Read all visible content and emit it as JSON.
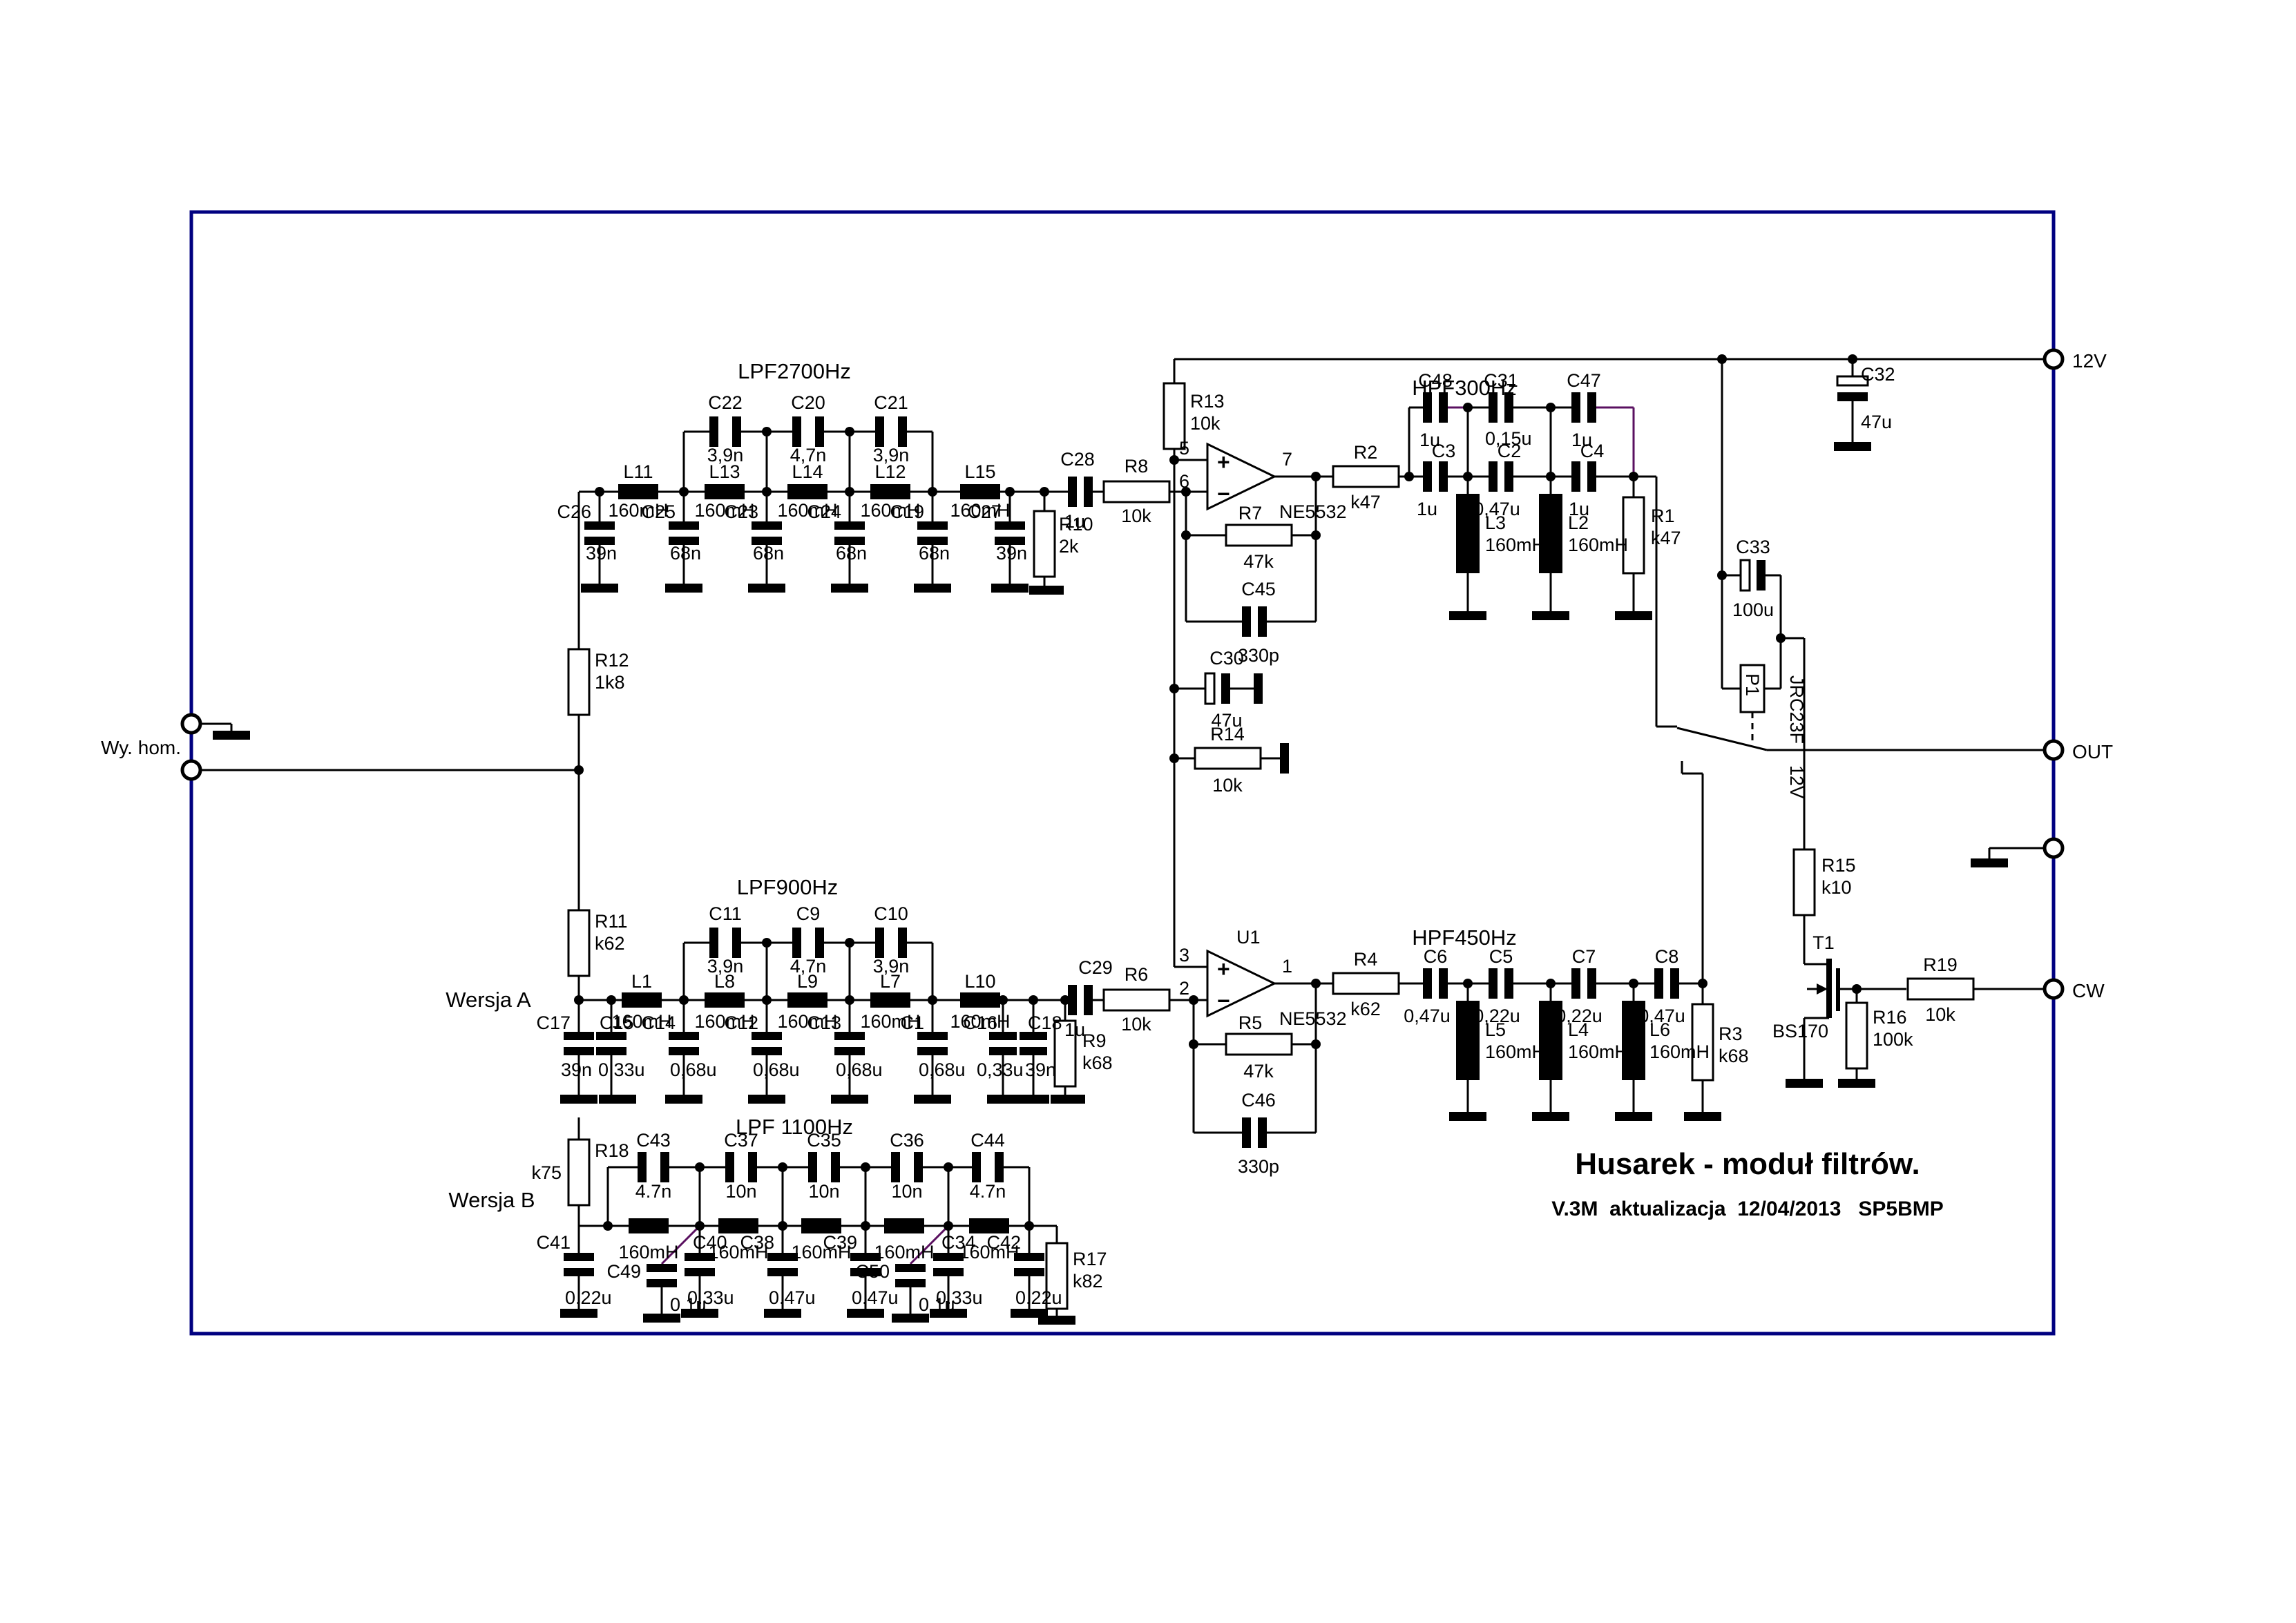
{
  "input": {
    "label": "Wy. hom."
  },
  "terminals": {
    "v12": "12V",
    "out": "OUT",
    "cw": "CW"
  },
  "versions": {
    "a": "Wersja A",
    "b": "Wersja B"
  },
  "title_block": {
    "title": "Husarek - moduł filtrów.",
    "subtitle": "V.3M  aktualizacja  12/04/2013   SP5BMP"
  },
  "lpf2700": {
    "title": "LPF2700Hz",
    "input_res": {
      "ref": "R12",
      "value": "1k8"
    },
    "bridges": [
      {
        "ref": "C22",
        "value": "3,9n"
      },
      {
        "ref": "C20",
        "value": "4,7n"
      },
      {
        "ref": "C21",
        "value": "3,9n"
      }
    ],
    "inductors": [
      {
        "ref": "L11",
        "value": "160mH"
      },
      {
        "ref": "L13",
        "value": "160mH"
      },
      {
        "ref": "L14",
        "value": "160mH"
      },
      {
        "ref": "L12",
        "value": "160mH"
      },
      {
        "ref": "L15",
        "value": "160mH"
      }
    ],
    "shunts": [
      {
        "ref": "C26",
        "value": "39n"
      },
      {
        "ref": "C25",
        "value": "68n"
      },
      {
        "ref": "C23",
        "value": "68n"
      },
      {
        "ref": "C24",
        "value": "68n"
      },
      {
        "ref": "C19",
        "value": "68n"
      },
      {
        "ref": "C27",
        "value": "39n"
      }
    ],
    "out_cap": {
      "ref": "C28",
      "value": "1u"
    },
    "shunt_res": {
      "ref": "R10",
      "value": "2k"
    },
    "series_res": {
      "ref": "R8",
      "value": "10k"
    }
  },
  "lpf900": {
    "title": "LPF900Hz",
    "input_res": {
      "ref": "R11",
      "value": "k62"
    },
    "bridges": [
      {
        "ref": "C11",
        "value": "3,9n"
      },
      {
        "ref": "C9",
        "value": "4,7n"
      },
      {
        "ref": "C10",
        "value": "3,9n"
      }
    ],
    "inductors": [
      {
        "ref": "L1",
        "value": "160mH"
      },
      {
        "ref": "L8",
        "value": "160mH"
      },
      {
        "ref": "L9",
        "value": "160mH"
      },
      {
        "ref": "L7",
        "value": "160mH"
      },
      {
        "ref": "L10",
        "value": "160mH"
      }
    ],
    "shunts": [
      {
        "ref": "C17",
        "value": "39n"
      },
      {
        "ref": "C15",
        "value": "0,33u"
      },
      {
        "ref": "C14",
        "value": "0,68u"
      },
      {
        "ref": "C12",
        "value": "0,68u"
      },
      {
        "ref": "C13",
        "value": "0,68u"
      },
      {
        "ref": "C1",
        "value": "0,68u"
      },
      {
        "ref": "C16",
        "value": "0,33u"
      },
      {
        "ref": "C18",
        "value": "39n"
      }
    ],
    "out_cap": {
      "ref": "C29",
      "value": "1u"
    },
    "shunt_res": {
      "ref": "R9",
      "value": "k68"
    },
    "series_res": {
      "ref": "R6",
      "value": "10k"
    }
  },
  "lpf1100": {
    "title": "LPF 1100Hz",
    "input_res": {
      "ref": "R18",
      "value": "k75"
    },
    "bridges": [
      {
        "ref": "C43",
        "value": "4.7n"
      },
      {
        "ref": "C37",
        "value": "10n"
      },
      {
        "ref": "C35",
        "value": "10n"
      },
      {
        "ref": "C36",
        "value": "10n"
      },
      {
        "ref": "C44",
        "value": "4.7n"
      }
    ],
    "inductor_value": "160mH",
    "shunts": [
      {
        "ref": "C41",
        "value": "0.22u"
      },
      {
        "ref": "C40",
        "value": "0.33u"
      },
      {
        "ref": "C38",
        "value": "0.47u"
      },
      {
        "ref": "C39",
        "value": "0.47u"
      },
      {
        "ref": "C34",
        "value": "0.33u"
      },
      {
        "ref": "C42",
        "value": "0.22u"
      }
    ],
    "mods": [
      {
        "ref": "C49",
        "value": "0.1u"
      },
      {
        "ref": "C50",
        "value": "0.1u"
      }
    ],
    "shunt_res": {
      "ref": "R17",
      "value": "k82"
    }
  },
  "hpf300": {
    "title": "HPF300Hz",
    "top_caps": [
      {
        "ref": "C48",
        "value": "1u"
      },
      {
        "ref": "C31",
        "value": "0,15u"
      },
      {
        "ref": "C47",
        "value": "1u"
      }
    ],
    "series_caps": [
      {
        "ref": "C3",
        "value": "1u"
      },
      {
        "ref": "C2",
        "value": "0,47u"
      },
      {
        "ref": "C4",
        "value": "1u"
      }
    ],
    "inductors": [
      {
        "ref": "L3",
        "value": "160mH"
      },
      {
        "ref": "L2",
        "value": "160mH"
      }
    ],
    "shunt_res": {
      "ref": "R1",
      "value": "k47"
    },
    "series_res": {
      "ref": "R2",
      "value": "k47"
    }
  },
  "hpf450": {
    "title": "HPF450Hz",
    "series_caps": [
      {
        "ref": "C6",
        "value": "0,47u"
      },
      {
        "ref": "C5",
        "value": "0,22u"
      },
      {
        "ref": "C7",
        "value": "0,22u"
      },
      {
        "ref": "C8",
        "value": "0,47u"
      }
    ],
    "inductors": [
      {
        "ref": "L5",
        "value": "160mH"
      },
      {
        "ref": "L4",
        "value": "160mH"
      },
      {
        "ref": "L6",
        "value": "160mH"
      }
    ],
    "shunt_res": {
      "ref": "R3",
      "value": "k68"
    },
    "series_res": {
      "ref": "R4",
      "value": "k62"
    }
  },
  "opamp1": {
    "part": "NE5532",
    "pin_plus": "5",
    "pin_minus": "6",
    "pin_out": "7",
    "plus": "+",
    "minus": "−",
    "fb_res": {
      "ref": "R7",
      "value": "47k"
    },
    "fb_cap": {
      "ref": "C45",
      "value": "330p"
    }
  },
  "opamp2": {
    "ref": "U1",
    "part": "NE5532",
    "pin_plus": "3",
    "pin_minus": "2",
    "pin_out": "1",
    "plus": "+",
    "minus": "−",
    "fb_res": {
      "ref": "R5",
      "value": "47k"
    },
    "fb_cap": {
      "ref": "C46",
      "value": "330p"
    }
  },
  "bias": {
    "top_res": {
      "ref": "R13",
      "value": "10k"
    },
    "bottom_res": {
      "ref": "R14",
      "value": "10k"
    },
    "cap": {
      "ref": "C30",
      "value": "47u"
    }
  },
  "power_cap": {
    "ref": "C32",
    "value": "47u"
  },
  "relay": {
    "ref": "P1",
    "part": "JRC23F",
    "voltage": "12V",
    "cap": {
      "ref": "C33",
      "value": "100u"
    },
    "series_res": {
      "ref": "R15",
      "value": "k10"
    }
  },
  "driver": {
    "ref": "T1",
    "part": "BS170",
    "gate_res": {
      "ref": "R16",
      "value": "100k"
    },
    "cw_res": {
      "ref": "R19",
      "value": "10k"
    }
  }
}
